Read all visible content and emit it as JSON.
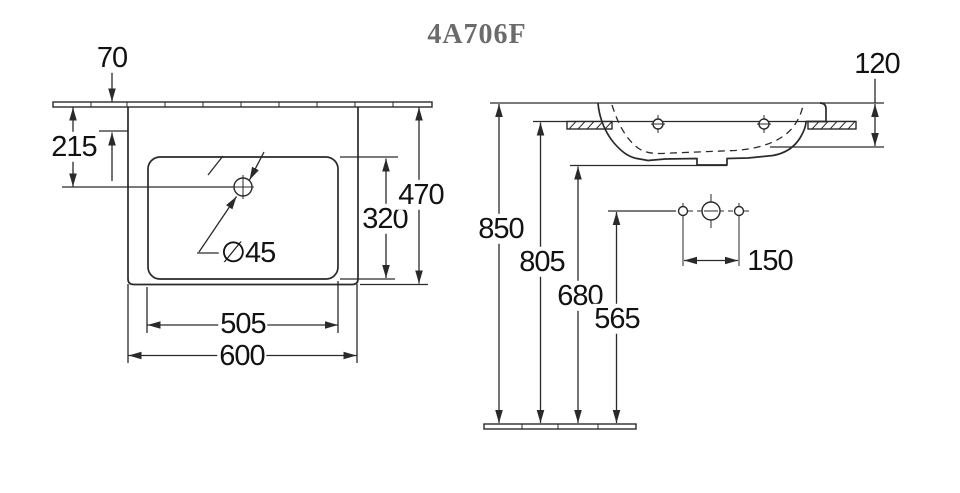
{
  "title": "4A706F",
  "colors": {
    "line": "#2a2a2a",
    "text": "#121212",
    "title": "#6b6b6b",
    "bg": "#ffffff"
  },
  "drawing": {
    "product_code": "4A706F",
    "top_view": {
      "dim_wall_to_edge": "70",
      "dim_wall_to_tap_center": "215",
      "dim_inner_depth": "320",
      "dim_overall_depth": "470",
      "dim_inner_width": "505",
      "dim_overall_width": "600",
      "dim_drain_diameter": "∅45"
    },
    "front_view": {
      "dim_rim_to_underside": "120",
      "dim_rim_height": "850",
      "dim_underside_height": "805",
      "dim_outlet_height": "680",
      "dim_supply_height": "565",
      "dim_hole_spacing": "150"
    }
  }
}
